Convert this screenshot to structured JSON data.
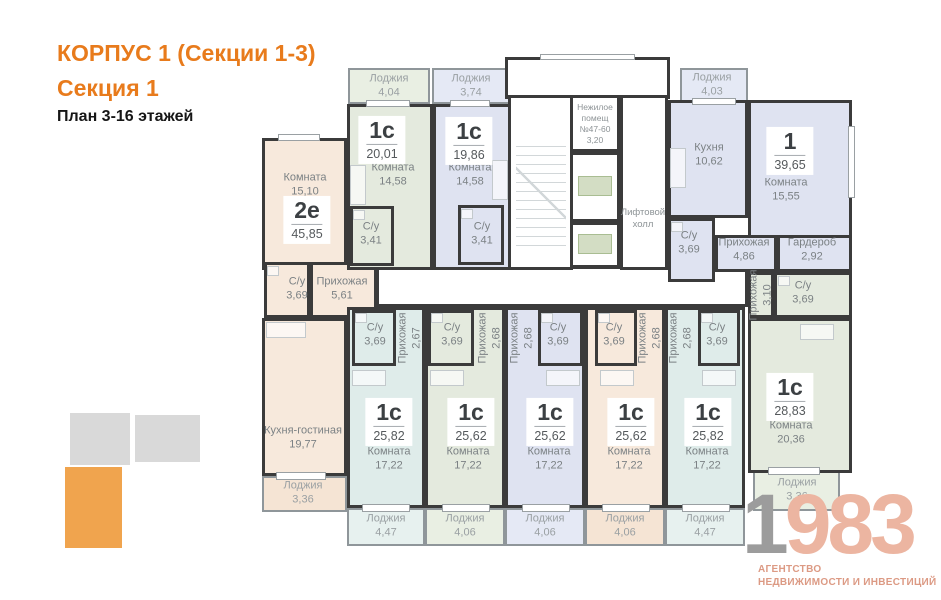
{
  "header": {
    "building": "КОРПУС 1 (Секции 1-3)",
    "section": "Секция 1",
    "floors": "План 3-16 этажей"
  },
  "colors": {
    "wall": "#3b3b3b",
    "accent": "#e87b1c",
    "white": "#ffffff",
    "beige": "#f7e9dc",
    "beigeL": "#f5e4d4",
    "green": "#e4eade",
    "greenL": "#e9efe3",
    "lav": "#dfe3f1",
    "lavL": "#e5e9f5",
    "cyan": "#dfecea",
    "cyanL": "#e7f1ef",
    "keyGray": "#d9d9d9",
    "keyOrange": "#f0a44e",
    "logoGray": "#9c9c9c",
    "logoSalmon": "#ecb5a1",
    "tagline": "#dc9a84"
  },
  "logo": {
    "gray": "1",
    "accent": "983",
    "tagline1": "АГЕНТСТВО",
    "tagline2": "НЕДВИЖИМОСТИ И ИНВЕСТИЦИЙ"
  },
  "plan": {
    "rooms": [
      {
        "n": "corridor",
        "x": 376,
        "y": 266,
        "w": 372,
        "h": 41,
        "f": "white"
      },
      {
        "n": "apt-2e-room",
        "x": 262,
        "y": 138,
        "w": 85,
        "h": 132,
        "f": "beige"
      },
      {
        "n": "apt-2e-bath",
        "x": 264,
        "y": 262,
        "w": 46,
        "h": 56,
        "f": "beige"
      },
      {
        "n": "apt-2e-hall",
        "x": 310,
        "y": 262,
        "w": 67,
        "h": 56,
        "f": "beige"
      },
      {
        "n": "apt-2e-kitchen-living",
        "x": 262,
        "y": 318,
        "w": 85,
        "h": 158,
        "f": "beige"
      },
      {
        "n": "apt-2e-loggia",
        "x": 262,
        "y": 476,
        "w": 85,
        "h": 36,
        "f": "beigeL",
        "c": "lodjia"
      },
      {
        "n": "apt-1c-2001-loggia",
        "x": 348,
        "y": 68,
        "w": 82,
        "h": 36,
        "f": "greenL",
        "c": "lodjia"
      },
      {
        "n": "apt-1c-2001-room",
        "x": 347,
        "y": 104,
        "w": 86,
        "h": 166,
        "f": "green"
      },
      {
        "n": "apt-1c-2001-bath",
        "x": 350,
        "y": 206,
        "w": 44,
        "h": 60,
        "f": "green"
      },
      {
        "n": "apt-1c-1986-loggia",
        "x": 432,
        "y": 68,
        "w": 78,
        "h": 36,
        "f": "lavL",
        "c": "lodjia"
      },
      {
        "n": "apt-1c-1986-room",
        "x": 433,
        "y": 104,
        "w": 79,
        "h": 166,
        "f": "lav"
      },
      {
        "n": "apt-1c-1986-bath",
        "x": 458,
        "y": 205,
        "w": 46,
        "h": 60,
        "f": "lav"
      },
      {
        "n": "entrance-vestibule",
        "x": 505,
        "y": 57,
        "w": 165,
        "h": 42,
        "f": "white"
      },
      {
        "n": "stairwell",
        "x": 508,
        "y": 95,
        "w": 65,
        "h": 175,
        "f": "white"
      },
      {
        "n": "non-residential",
        "x": 570,
        "y": 95,
        "w": 50,
        "h": 57,
        "f": "white"
      },
      {
        "n": "elevator-shaft-1",
        "x": 570,
        "y": 152,
        "w": 50,
        "h": 70,
        "f": "white"
      },
      {
        "n": "elevator-shaft-2",
        "x": 570,
        "y": 222,
        "w": 50,
        "h": 46,
        "f": "white"
      },
      {
        "n": "elevator-hall",
        "x": 620,
        "y": 95,
        "w": 48,
        "h": 175,
        "f": "white"
      },
      {
        "n": "apt-1-loggia",
        "x": 680,
        "y": 68,
        "w": 68,
        "h": 34,
        "f": "lavL",
        "c": "lodjia"
      },
      {
        "n": "apt-1-kitchen",
        "x": 668,
        "y": 100,
        "w": 80,
        "h": 118,
        "f": "lav"
      },
      {
        "n": "apt-1-room",
        "x": 748,
        "y": 100,
        "w": 104,
        "h": 138,
        "f": "lav"
      },
      {
        "n": "apt-1-bath",
        "x": 668,
        "y": 218,
        "w": 47,
        "h": 64,
        "f": "lav"
      },
      {
        "n": "apt-1-hall",
        "x": 715,
        "y": 235,
        "w": 62,
        "h": 37,
        "f": "lav"
      },
      {
        "n": "apt-1-wardrobe",
        "x": 777,
        "y": 235,
        "w": 75,
        "h": 37,
        "f": "lav"
      },
      {
        "n": "apt-a-unit",
        "x": 347,
        "y": 307,
        "w": 78,
        "h": 201,
        "f": "cyan"
      },
      {
        "n": "apt-a-bath",
        "x": 352,
        "y": 310,
        "w": 44,
        "h": 56,
        "f": "cyan"
      },
      {
        "n": "apt-b-unit",
        "x": 425,
        "y": 307,
        "w": 80,
        "h": 201,
        "f": "green"
      },
      {
        "n": "apt-b-bath",
        "x": 428,
        "y": 310,
        "w": 46,
        "h": 56,
        "f": "green"
      },
      {
        "n": "apt-c-unit",
        "x": 505,
        "y": 307,
        "w": 80,
        "h": 201,
        "f": "lav"
      },
      {
        "n": "apt-c-bath",
        "x": 538,
        "y": 310,
        "w": 45,
        "h": 56,
        "f": "lav"
      },
      {
        "n": "apt-d-unit",
        "x": 585,
        "y": 307,
        "w": 80,
        "h": 201,
        "f": "beige"
      },
      {
        "n": "apt-d-bath",
        "x": 595,
        "y": 310,
        "w": 42,
        "h": 56,
        "f": "beige"
      },
      {
        "n": "apt-e-unit",
        "x": 665,
        "y": 307,
        "w": 80,
        "h": 201,
        "f": "cyan"
      },
      {
        "n": "apt-e-bath",
        "x": 698,
        "y": 310,
        "w": 42,
        "h": 56,
        "f": "cyan"
      },
      {
        "n": "apt-f-hall",
        "x": 748,
        "y": 272,
        "w": 26,
        "h": 46,
        "f": "green"
      },
      {
        "n": "apt-f-bath",
        "x": 774,
        "y": 272,
        "w": 78,
        "h": 46,
        "f": "green"
      },
      {
        "n": "apt-f-room",
        "x": 748,
        "y": 318,
        "w": 104,
        "h": 155,
        "f": "green"
      },
      {
        "n": "apt-f-loggia",
        "x": 753,
        "y": 471,
        "w": 87,
        "h": 40,
        "f": "greenL",
        "c": "lodjia"
      },
      {
        "n": "loggia-a",
        "x": 347,
        "y": 508,
        "w": 78,
        "h": 38,
        "f": "cyanL",
        "c": "lodjia"
      },
      {
        "n": "loggia-b",
        "x": 425,
        "y": 508,
        "w": 80,
        "h": 38,
        "f": "greenL",
        "c": "lodjia"
      },
      {
        "n": "loggia-c",
        "x": 505,
        "y": 508,
        "w": 80,
        "h": 38,
        "f": "lavL",
        "c": "lodjia"
      },
      {
        "n": "loggia-d",
        "x": 585,
        "y": 508,
        "w": 80,
        "h": 38,
        "f": "beigeL",
        "c": "lodjia"
      },
      {
        "n": "loggia-e",
        "x": 665,
        "y": 508,
        "w": 80,
        "h": 38,
        "f": "cyanL",
        "c": "lodjia"
      }
    ],
    "labels": [
      {
        "x": 305,
        "y": 185,
        "l": [
          "Комната",
          "15,10"
        ]
      },
      {
        "x": 393,
        "y": 175,
        "l": [
          "Комната",
          "14,58"
        ]
      },
      {
        "x": 470,
        "y": 175,
        "l": [
          "Комната",
          "14,58"
        ]
      },
      {
        "x": 709,
        "y": 155,
        "l": [
          "Кухня",
          "10,62"
        ]
      },
      {
        "x": 786,
        "y": 190,
        "l": [
          "Комната",
          "15,55"
        ]
      },
      {
        "x": 689,
        "y": 243,
        "l": [
          "С/у",
          "3,69"
        ]
      },
      {
        "x": 744,
        "y": 250,
        "l": [
          "Прихожая",
          "4,86"
        ]
      },
      {
        "x": 812,
        "y": 250,
        "l": [
          "Гардероб",
          "2,92"
        ]
      },
      {
        "x": 297,
        "y": 289,
        "l": [
          "С/у",
          "3,69"
        ]
      },
      {
        "x": 342,
        "y": 289,
        "l": [
          "Прихожая",
          "5,61"
        ]
      },
      {
        "x": 303,
        "y": 438,
        "l": [
          "Кухня-гостиная",
          "19,77"
        ]
      },
      {
        "x": 371,
        "y": 234,
        "l": [
          "С/у",
          "3,41"
        ]
      },
      {
        "x": 482,
        "y": 234,
        "l": [
          "С/у",
          "3,41"
        ]
      },
      {
        "x": 375,
        "y": 335,
        "l": [
          "С/у",
          "3,69"
        ]
      },
      {
        "x": 452,
        "y": 335,
        "l": [
          "С/у",
          "3,69"
        ]
      },
      {
        "x": 558,
        "y": 335,
        "l": [
          "С/у",
          "3,69"
        ]
      },
      {
        "x": 614,
        "y": 335,
        "l": [
          "С/у",
          "3,69"
        ]
      },
      {
        "x": 717,
        "y": 335,
        "l": [
          "С/у",
          "3,69"
        ]
      },
      {
        "x": 803,
        "y": 293,
        "l": [
          "С/у",
          "3,69"
        ]
      },
      {
        "x": 389,
        "y": 459,
        "l": [
          "Комната",
          "17,22"
        ]
      },
      {
        "x": 468,
        "y": 459,
        "l": [
          "Комната",
          "17,22"
        ]
      },
      {
        "x": 549,
        "y": 459,
        "l": [
          "Комната",
          "17,22"
        ]
      },
      {
        "x": 629,
        "y": 459,
        "l": [
          "Комната",
          "17,22"
        ]
      },
      {
        "x": 707,
        "y": 459,
        "l": [
          "Комната",
          "17,22"
        ]
      },
      {
        "x": 791,
        "y": 433,
        "l": [
          "Комната",
          "20,36"
        ]
      },
      {
        "x": 410,
        "y": 338,
        "l": [
          "Прихожая",
          "2,67"
        ],
        "r": 1
      },
      {
        "x": 490,
        "y": 338,
        "l": [
          "Прихожая",
          "2,68"
        ],
        "r": 1
      },
      {
        "x": 522,
        "y": 338,
        "l": [
          "Прихожая",
          "2,68"
        ],
        "r": 1
      },
      {
        "x": 650,
        "y": 338,
        "l": [
          "Прихожая",
          "2,68"
        ],
        "r": 1
      },
      {
        "x": 681,
        "y": 338,
        "l": [
          "Прихожая",
          "2,68"
        ],
        "r": 1
      },
      {
        "x": 761,
        "y": 295,
        "l": [
          "Прихожая",
          "3,10"
        ],
        "r": 1
      },
      {
        "x": 389,
        "y": 86,
        "l": [
          "Лоджия",
          "4,04"
        ],
        "c": "lod"
      },
      {
        "x": 471,
        "y": 86,
        "l": [
          "Лоджия",
          "3,74"
        ],
        "c": "lod"
      },
      {
        "x": 712,
        "y": 85,
        "l": [
          "Лоджия",
          "4,03"
        ],
        "c": "lod"
      },
      {
        "x": 303,
        "y": 493,
        "l": [
          "Лоджия",
          "3,36"
        ],
        "c": "lod"
      },
      {
        "x": 386,
        "y": 526,
        "l": [
          "Лоджия",
          "4,47"
        ],
        "c": "lod"
      },
      {
        "x": 465,
        "y": 526,
        "l": [
          "Лоджия",
          "4,06"
        ],
        "c": "lod"
      },
      {
        "x": 545,
        "y": 526,
        "l": [
          "Лоджия",
          "4,06"
        ],
        "c": "lod"
      },
      {
        "x": 625,
        "y": 526,
        "l": [
          "Лоджия",
          "4,06"
        ],
        "c": "lod"
      },
      {
        "x": 705,
        "y": 526,
        "l": [
          "Лоджия",
          "4,47"
        ],
        "c": "lod"
      },
      {
        "x": 797,
        "y": 490,
        "l": [
          "Лоджия",
          "3,36"
        ],
        "c": "lod"
      },
      {
        "x": 595,
        "y": 124,
        "l": [
          "Нежилое",
          "помещ",
          "№47-60",
          "3,20"
        ],
        "c": "core"
      },
      {
        "x": 643,
        "y": 219,
        "l": [
          "Лифтовой",
          "холл"
        ],
        "c": "core2"
      }
    ],
    "badges": [
      {
        "x": 307,
        "y": 220,
        "t": "2е",
        "a": "45,85"
      },
      {
        "x": 382,
        "y": 140,
        "t": "1с",
        "a": "20,01"
      },
      {
        "x": 469,
        "y": 141,
        "t": "1с",
        "a": "19,86"
      },
      {
        "x": 790,
        "y": 151,
        "t": "1",
        "a": "39,65"
      },
      {
        "x": 389,
        "y": 422,
        "t": "1с",
        "a": "25,82"
      },
      {
        "x": 471,
        "y": 422,
        "t": "1с",
        "a": "25,62"
      },
      {
        "x": 550,
        "y": 422,
        "t": "1с",
        "a": "25,62"
      },
      {
        "x": 631,
        "y": 422,
        "t": "1с",
        "a": "25,62"
      },
      {
        "x": 708,
        "y": 422,
        "t": "1с",
        "a": "25,82"
      },
      {
        "x": 790,
        "y": 397,
        "t": "1с",
        "a": "28,83"
      }
    ],
    "windows": [
      {
        "x": 278,
        "y": 134,
        "w": 42,
        "h": 7
      },
      {
        "x": 366,
        "y": 100,
        "w": 44,
        "h": 7
      },
      {
        "x": 450,
        "y": 100,
        "w": 40,
        "h": 7
      },
      {
        "x": 692,
        "y": 98,
        "w": 44,
        "h": 7
      },
      {
        "x": 540,
        "y": 54,
        "w": 95,
        "h": 6
      },
      {
        "x": 848,
        "y": 126,
        "w": 7,
        "h": 72
      },
      {
        "x": 276,
        "y": 472,
        "w": 50,
        "h": 8
      },
      {
        "x": 362,
        "y": 504,
        "w": 48,
        "h": 8
      },
      {
        "x": 442,
        "y": 504,
        "w": 48,
        "h": 8
      },
      {
        "x": 522,
        "y": 504,
        "w": 48,
        "h": 8
      },
      {
        "x": 602,
        "y": 504,
        "w": 48,
        "h": 8
      },
      {
        "x": 682,
        "y": 504,
        "w": 48,
        "h": 8
      },
      {
        "x": 768,
        "y": 467,
        "w": 52,
        "h": 8
      }
    ],
    "fixtures": [
      {
        "x": 355,
        "y": 313,
        "w": 12,
        "h": 10
      },
      {
        "x": 431,
        "y": 313,
        "w": 12,
        "h": 10
      },
      {
        "x": 541,
        "y": 313,
        "w": 12,
        "h": 10
      },
      {
        "x": 598,
        "y": 313,
        "w": 12,
        "h": 10
      },
      {
        "x": 701,
        "y": 313,
        "w": 12,
        "h": 10
      },
      {
        "x": 353,
        "y": 210,
        "w": 12,
        "h": 10
      },
      {
        "x": 461,
        "y": 209,
        "w": 12,
        "h": 10
      },
      {
        "x": 267,
        "y": 266,
        "w": 12,
        "h": 10
      },
      {
        "x": 671,
        "y": 222,
        "w": 12,
        "h": 10
      },
      {
        "x": 778,
        "y": 276,
        "w": 12,
        "h": 10
      },
      {
        "x": 352,
        "y": 370,
        "w": 34,
        "h": 16
      },
      {
        "x": 430,
        "y": 370,
        "w": 34,
        "h": 16
      },
      {
        "x": 546,
        "y": 370,
        "w": 34,
        "h": 16
      },
      {
        "x": 600,
        "y": 370,
        "w": 34,
        "h": 16
      },
      {
        "x": 702,
        "y": 370,
        "w": 34,
        "h": 16
      },
      {
        "x": 800,
        "y": 324,
        "w": 34,
        "h": 16
      },
      {
        "x": 350,
        "y": 165,
        "w": 16,
        "h": 40
      },
      {
        "x": 492,
        "y": 160,
        "w": 16,
        "h": 40
      },
      {
        "x": 670,
        "y": 148,
        "w": 16,
        "h": 40
      },
      {
        "x": 266,
        "y": 322,
        "w": 40,
        "h": 16
      }
    ],
    "lifts": [
      {
        "x": 578,
        "y": 176,
        "w": 34,
        "h": 20
      },
      {
        "x": 578,
        "y": 234,
        "w": 34,
        "h": 20
      }
    ]
  }
}
